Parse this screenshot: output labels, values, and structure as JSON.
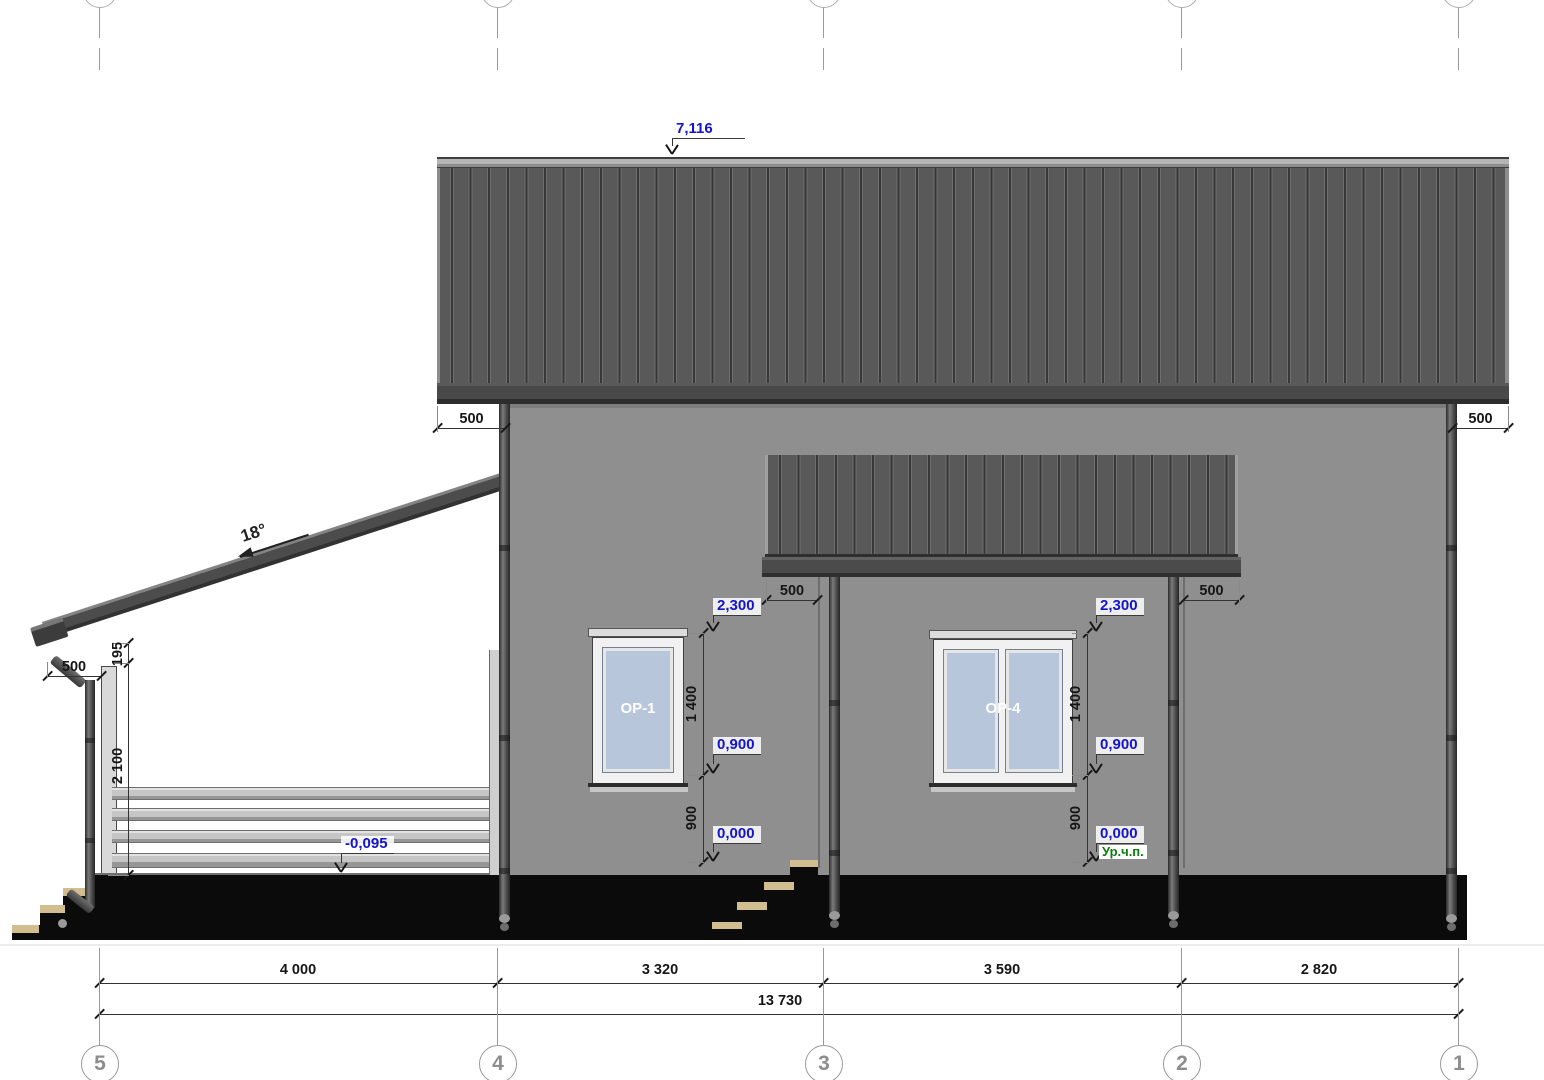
{
  "grid": {
    "labels": [
      "5",
      "4",
      "3",
      "2",
      "1"
    ]
  },
  "dimensions": {
    "bottom": [
      "4 000",
      "3 320",
      "3 590",
      "2 820"
    ],
    "total": "13 730",
    "eave_overhang_left": "500",
    "eave_overhang_right": "500",
    "canopy_overhang_left": "500",
    "canopy_overhang_right": "500",
    "porch_roof_overhang": "500",
    "porch_beam_offset": "195",
    "porch_post_height": "2 100",
    "window_height": "1 400",
    "window_sill_height": "900"
  },
  "elevations": {
    "ridge": "7,116",
    "window_head": "2,300",
    "window_sill": "0,900",
    "ground_floor": "0,000",
    "ground_floor_note": "Ур.ч.п.",
    "porch_floor": "-0,095"
  },
  "labels": {
    "roof_slope": "18°",
    "window_left": "ОР-1",
    "window_right": "ОР-4"
  },
  "colors": {
    "wall": "#8f8f8f",
    "roof": "#575757",
    "ground": "#0b0b0b",
    "glass": "#b7c6da",
    "tread": "#d2bd90",
    "elevation_text": "#1414cc",
    "floor_note_text": "#0b7d0b"
  }
}
